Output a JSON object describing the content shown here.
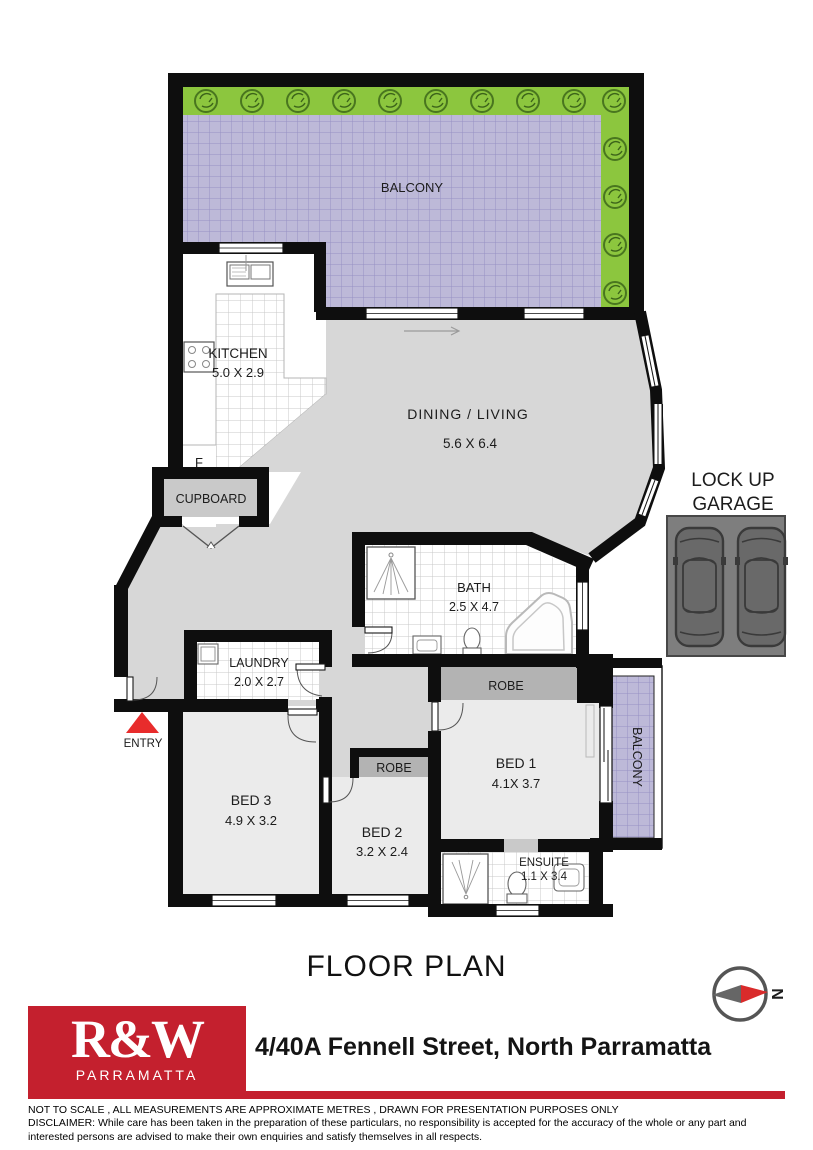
{
  "plan": {
    "balcony_top": {
      "label": "BALCONY"
    },
    "kitchen": {
      "label": "KITCHEN",
      "dims": "5.0 X 2.9"
    },
    "dining": {
      "label": "DINING / LIVING",
      "dims": "5.6 X 6.4"
    },
    "cupboard": {
      "label": "CUPBOARD"
    },
    "fridge": {
      "label": "F"
    },
    "entry": {
      "label": "ENTRY"
    },
    "laundry": {
      "label": "LAUNDRY",
      "dims": "2.0 X 2.7"
    },
    "bath": {
      "label": "BATH",
      "dims": "2.5 X 4.7"
    },
    "robe1": {
      "label": "ROBE"
    },
    "robe2": {
      "label": "ROBE"
    },
    "bed1": {
      "label": "BED 1",
      "dims": "4.1X 3.7"
    },
    "bed2": {
      "label": "BED 2",
      "dims": "3.2 X 2.4"
    },
    "bed3": {
      "label": "BED 3",
      "dims": "4.9 X 3.2"
    },
    "ensuite": {
      "label": "ENSUITE",
      "dims": "1.1 X 3.4"
    },
    "balcony_right": {
      "label": "BALCONY"
    },
    "garage": {
      "line1": "LOCK UP",
      "line2": "GARAGE"
    }
  },
  "footer": {
    "title": "FLOOR PLAN",
    "compass_letter": "N",
    "logo": {
      "brand": "R&W",
      "sub": "PARRAMATTA"
    },
    "address": "4/40A Fennell Street, North Parramatta",
    "note": "NOT TO SCALE , ALL MEASUREMENTS ARE APPROXIMATE METRES , DRAWN FOR PRESENTATION PURPOSES ONLY",
    "disclaimer": "DISCLAIMER:  While care has been taken in the preparation of these particulars, no responsibility is accepted for the accuracy of the whole or any part and interested persons are advised to make their own enquiries and satisfy  themselves in all respects."
  },
  "colors": {
    "brand_red": "#c4202e",
    "entry_arrow_red": "#e82c2c",
    "wall_black": "#0e0e0e",
    "balcony_purple": "#bdb9d8",
    "planter_green": "#8cc63e",
    "floor_gray": "#d7d7d7",
    "bedroom_gray": "#ebebeb",
    "robe_gray": "#b3b3b3",
    "garage_gray": "#7e7e7e"
  }
}
